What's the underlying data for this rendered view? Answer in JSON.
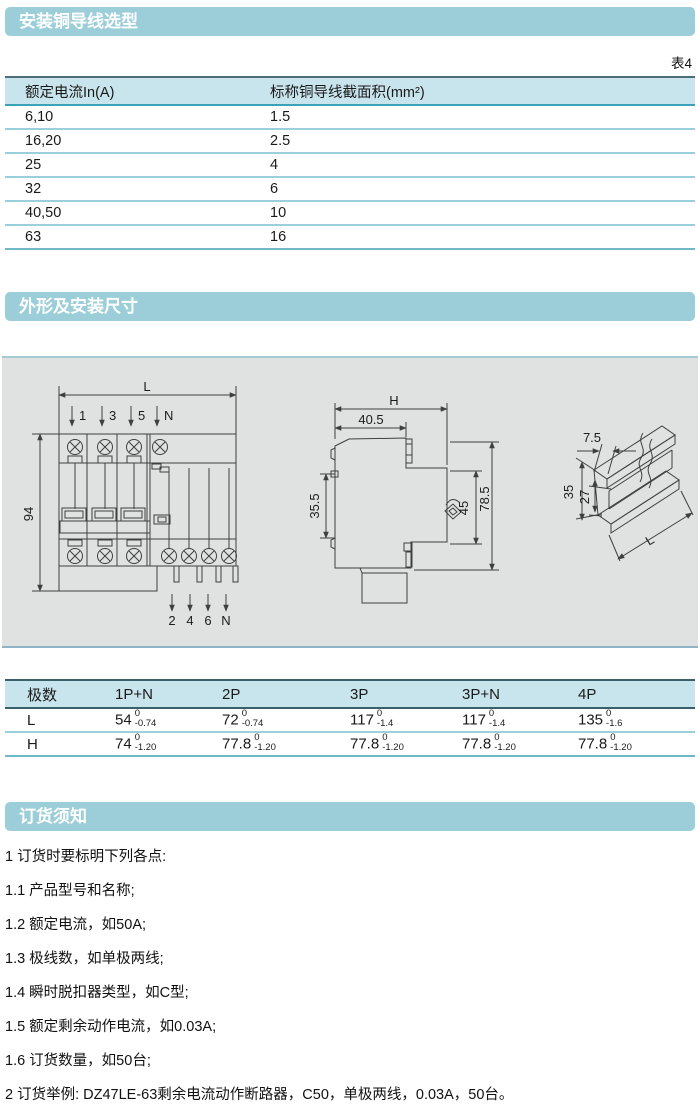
{
  "colors": {
    "section_header_bg": "#9bced8",
    "section_header_text": "#ffffff",
    "table_header_bg": "#c8e4ec",
    "table_accent_line": "#3aa3b7",
    "table_row_line": "#9ad0dc",
    "table_frame_line": "#3c5f6c",
    "panel_bg": "#e0e1e1",
    "drawing_line": "#3f3f3f"
  },
  "section1": {
    "title": "安装铜导线选型",
    "table_label": "表4",
    "table": {
      "col1_header": "额定电流In(A)",
      "col2_header": "标称铜导线截面积(mm²)",
      "rows": [
        {
          "current": "6,10",
          "area": "1.5"
        },
        {
          "current": "16,20",
          "area": "2.5"
        },
        {
          "current": "25",
          "area": "4"
        },
        {
          "current": "32",
          "area": "6"
        },
        {
          "current": "40,50",
          "area": "10"
        },
        {
          "current": "63",
          "area": "16"
        }
      ]
    }
  },
  "section2": {
    "title": "外形及安装尺寸",
    "front_view": {
      "dim_width": "L",
      "dim_height": "94",
      "top_terminals": [
        "1",
        "3",
        "5",
        "N"
      ],
      "bottom_terminals": [
        "2",
        "4",
        "6",
        "N"
      ]
    },
    "side_view": {
      "dim_total_width": "H",
      "dim_top_width": "40.5",
      "dim_left_height": "35.5",
      "dim_front_height": "45",
      "dim_total_height": "78.5"
    },
    "rail_view": {
      "dim_depth": "7.5",
      "dim_height": "35",
      "dim_inner": "27",
      "dim_length": "L"
    },
    "dim_table": {
      "headers": [
        "极数",
        "1P+N",
        "2P",
        "3P",
        "3P+N",
        "4P"
      ],
      "rows": [
        {
          "label": "L",
          "values": [
            {
              "v": "54",
              "sup": "0",
              "sub": "-0.74"
            },
            {
              "v": "72",
              "sup": "0",
              "sub": "-0.74"
            },
            {
              "v": "117",
              "sup": "0",
              "sub": "-1.4"
            },
            {
              "v": "117",
              "sup": "0",
              "sub": "-1.4"
            },
            {
              "v": "135",
              "sup": "0",
              "sub": "-1.6"
            }
          ]
        },
        {
          "label": "H",
          "values": [
            {
              "v": "74",
              "sup": "0",
              "sub": "-1.20"
            },
            {
              "v": "77.8",
              "sup": "0",
              "sub": "-1.20"
            },
            {
              "v": "77.8",
              "sup": "0",
              "sub": "-1.20"
            },
            {
              "v": "77.8",
              "sup": "0",
              "sub": "-1.20"
            },
            {
              "v": "77.8",
              "sup": "0",
              "sub": "-1.20"
            }
          ]
        }
      ]
    }
  },
  "section3": {
    "title": "订货须知",
    "lines": [
      "1 订货时要标明下列各点:",
      "1.1 产品型号和名称;",
      "1.2 额定电流，如50A;",
      "1.3 极线数，如单极两线;",
      "1.4 瞬时脱扣器类型，如C型;",
      "1.5 额定剩余动作电流，如0.03A;",
      "1.6 订货数量，如50台;",
      "2 订货举例: DZ47LE-63剩余电流动作断路器，C50，单极两线，0.03A，50台。"
    ]
  }
}
